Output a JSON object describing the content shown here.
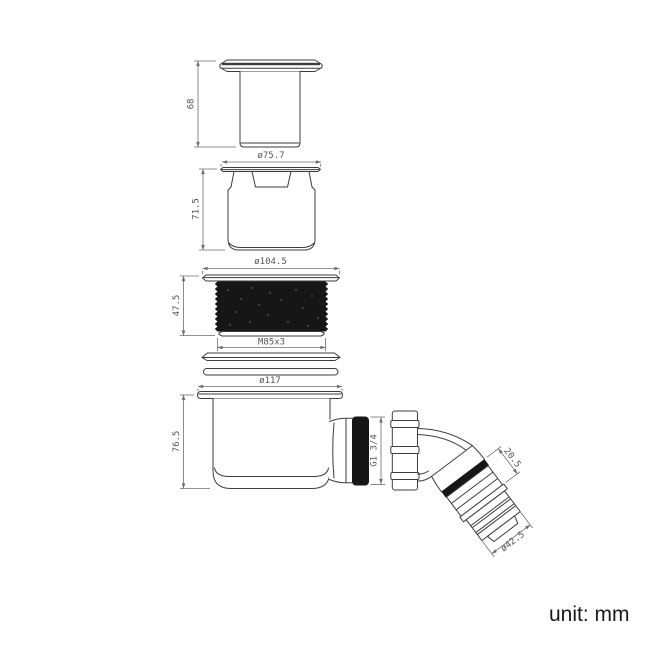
{
  "unit_note": "unit: mm",
  "dims": {
    "cover_height": "68",
    "cover_flange_dia": "ø75.7",
    "insert_height": "71.5",
    "ring_flange_dia": "ø104.5",
    "ring_height": "47.5",
    "ring_thread": "M85x3",
    "body_flange_dia": "ø117",
    "body_height": "76.5",
    "outlet_thread": "G1 3/4",
    "elbow_segment_length": "20.5",
    "elbow_outlet_dia": "ø42.5"
  },
  "components": [
    {
      "name": "cover-cap"
    },
    {
      "name": "insert-cup"
    },
    {
      "name": "threaded-locknut"
    },
    {
      "name": "sealing-washers"
    },
    {
      "name": "trap-body-with-outlet"
    },
    {
      "name": "elbow-connector-45deg"
    }
  ]
}
